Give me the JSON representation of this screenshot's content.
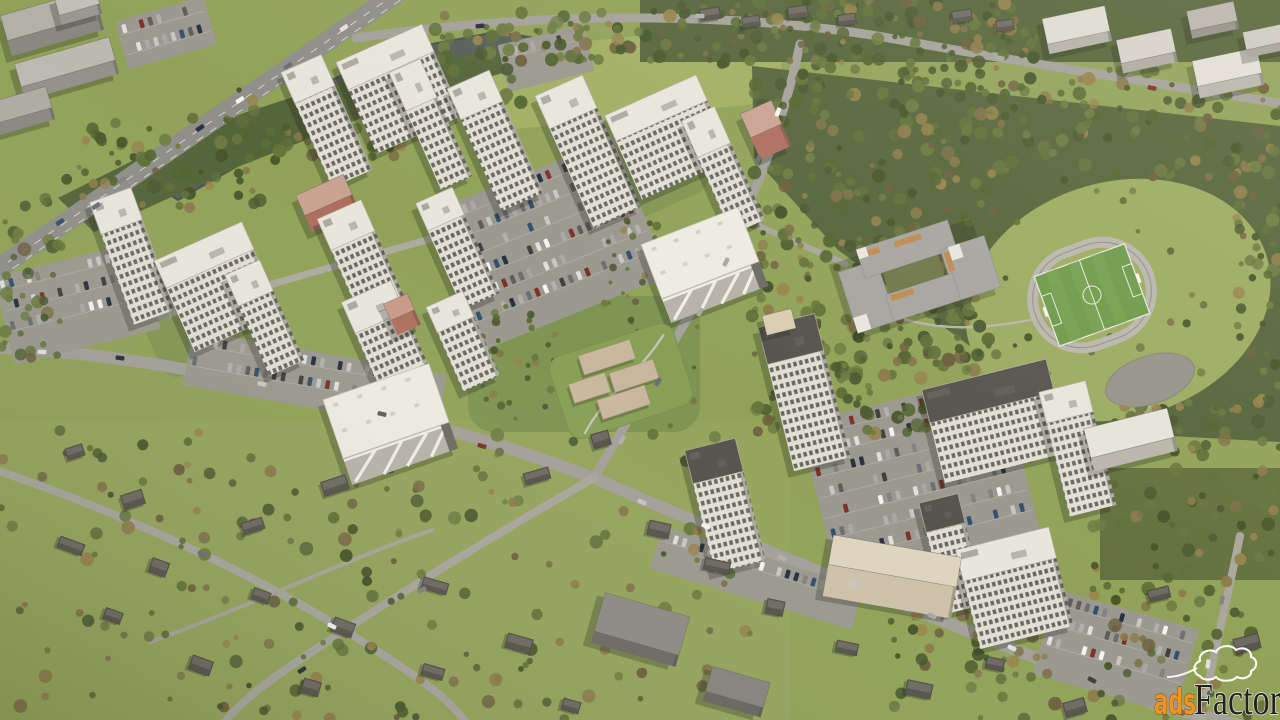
{
  "image": {
    "type": "3d-aerial-architectural-render",
    "subject": "residential-complex-masterplan-with-forest-stadium-and-suburb"
  },
  "watermark": {
    "ads_text": "ads",
    "factory_text": "Factory",
    "ads_fill": "#ee9421",
    "ads_outline": "#6d3c0a",
    "factory_fill": "#22211f",
    "factory_outline": "#f2f0ea",
    "cloud_outline": "#ffffff"
  },
  "palette": {
    "grass": "#91a258",
    "grass_suburb": "#97a55d",
    "meadow": "#a3b164",
    "courtyard": "#7f9452",
    "forest": "#55653a",
    "forest_light": "#63703e",
    "water": "#566058",
    "water_edge": "#49524b",
    "road": "#a3a199",
    "road_minor": "#a9a79d",
    "highway": "#8f8e88",
    "lot": "#9b998f",
    "roof_light": "#e8e5dc",
    "roof_dark": "#56544d",
    "face_shade": "#bdb8ac",
    "salmon_roof": "#c9a291",
    "salmon_face": "#ad6e5e",
    "cream_roof": "#ded4c0",
    "cream_face": "#cec2a9",
    "school_roof": "#a7a5a0",
    "school_accent": "#c08a50",
    "field_green": "#6f9a4a",
    "track": "#b9b7ad",
    "house_body": "#57544d",
    "house_roof": "#6e6a62",
    "tree_greens": [
      "#4a5930",
      "#53642f",
      "#5f7038",
      "#445428",
      "#6d7b41",
      "#66753c"
    ],
    "tree_browns": [
      "#7d7048",
      "#8a7a4a",
      "#6b5f3d",
      "#96834b"
    ],
    "car_colors": [
      "#f4f3f0",
      "#e0dfdb",
      "#c7c6c2",
      "#a8a7a3",
      "#83827e",
      "#5f5e5b",
      "#403f3d",
      "#27313f",
      "#7e302b",
      "#32506f",
      "#6b6f74",
      "#b0b0ac"
    ]
  }
}
